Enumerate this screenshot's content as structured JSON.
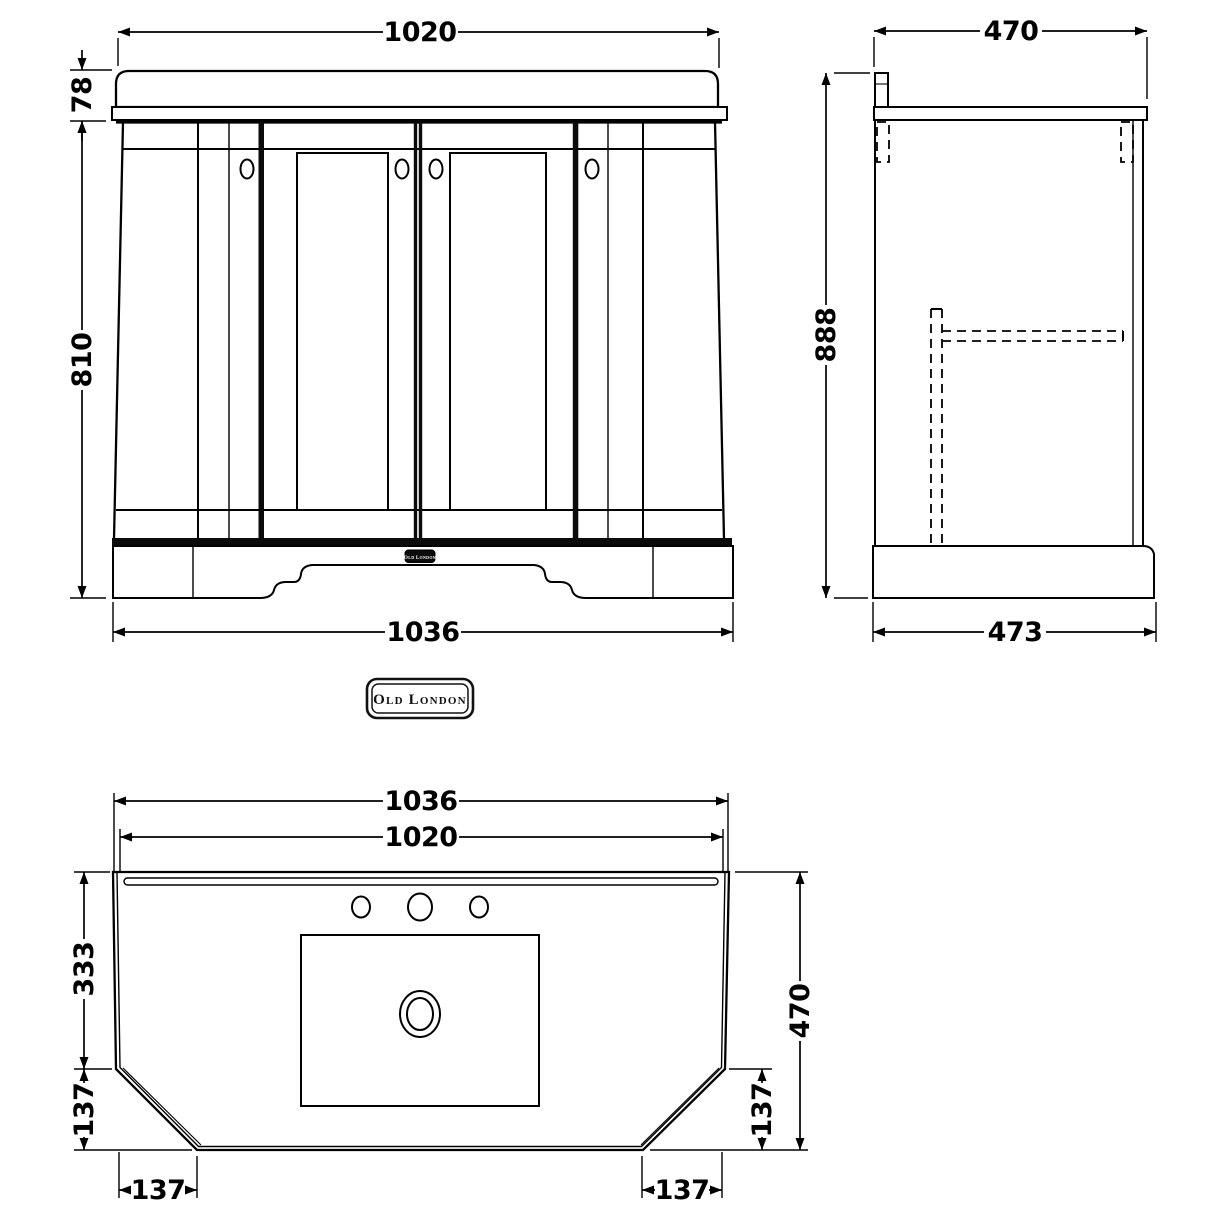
{
  "meta": {
    "drawing_type": "technical dimension drawing, bathroom vanity basin unit",
    "background": "#ffffff",
    "line_color": "#000000"
  },
  "brand": {
    "logo_text": "Old London",
    "plinth_badge_text": "Old London"
  },
  "views": {
    "front": {
      "label": "front elevation",
      "dims": {
        "top_width": "1020",
        "worktop_height": "78",
        "cabinet_height": "810",
        "base_width": "1036"
      }
    },
    "side": {
      "label": "side elevation",
      "dims": {
        "top_depth": "470",
        "overall_height": "888",
        "base_depth": "473"
      }
    },
    "plan": {
      "label": "basin plan view",
      "dims": {
        "overall_width": "1036",
        "basin_width": "1020",
        "front_to_chamfer": "333",
        "chamfer_depth_left": "137",
        "chamfer_width_left": "137",
        "overall_depth": "470",
        "chamfer_depth_right": "137",
        "chamfer_width_right": "137"
      }
    }
  }
}
